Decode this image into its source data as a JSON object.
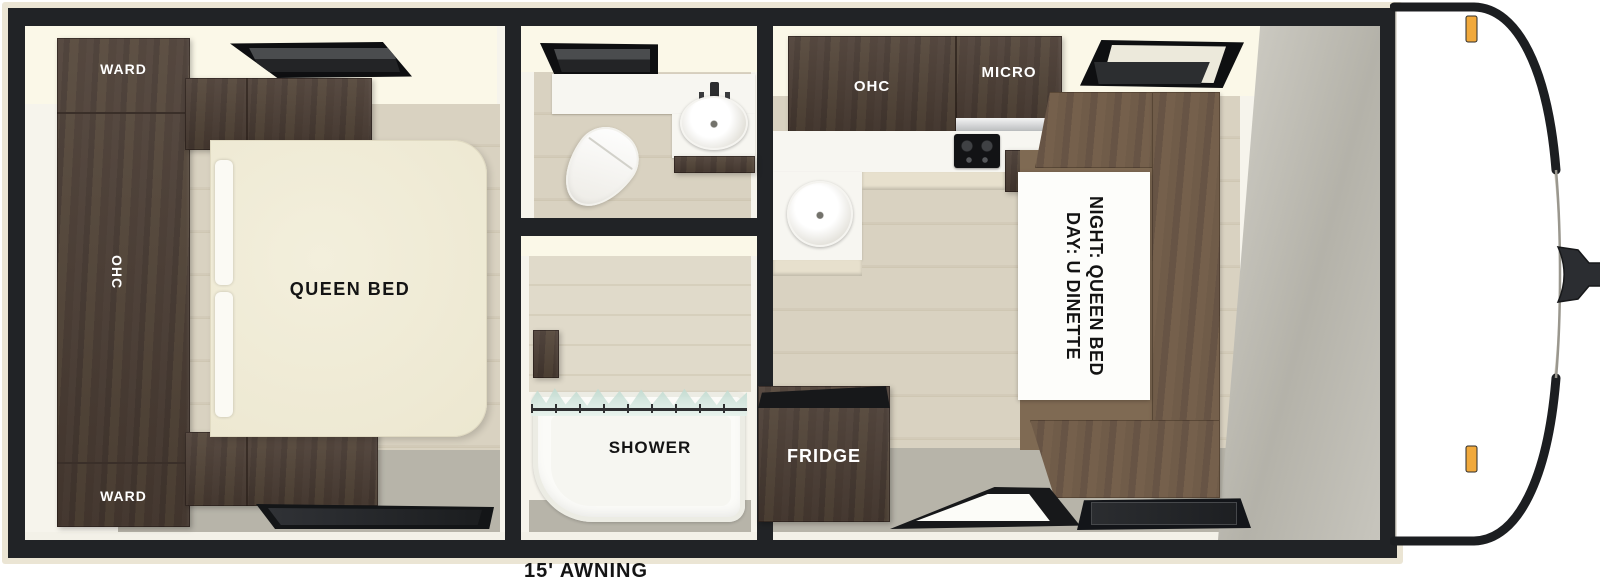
{
  "floorplan": {
    "bedroom": {
      "ward_top": "WARD",
      "ohc": "OHC",
      "ward_bottom": "WARD",
      "queen_bed": "QUEEN BED"
    },
    "shower": {
      "label": "SHOWER"
    },
    "kitchen": {
      "ohc": "OHC",
      "micro": "MICRO",
      "fridge": "FRIDGE"
    },
    "dinette": {
      "line1": "DAY: U DINETTE",
      "line2": "NIGHT: QUEEN BED"
    },
    "awning_label": "15' AWNING",
    "colors": {
      "cabinet_dark": "#4c3e35",
      "dinette_back": "#6d5a47",
      "dinette_seat": "#7f6a53",
      "floor_wood": "#d6cfbe",
      "floor_gray": "#b7b4a9",
      "ceiling_cream": "#fbf8e8",
      "wall_black": "#212326",
      "outline_cream": "#ebe5d4",
      "marker_light": "#f1a93c",
      "bed_cream": "#f1edda"
    }
  }
}
